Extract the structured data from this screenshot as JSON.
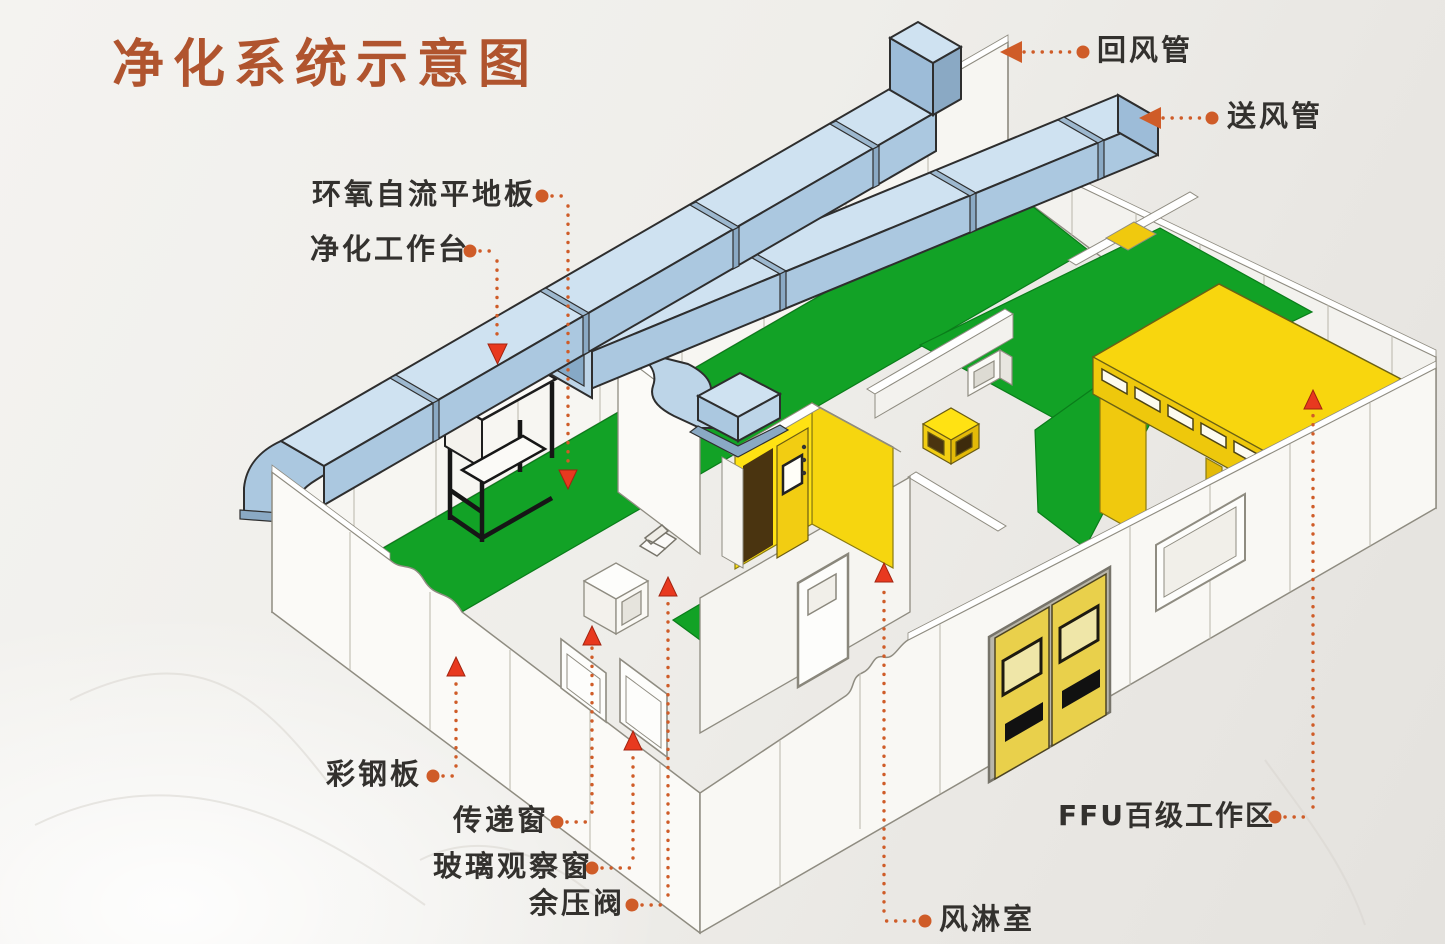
{
  "title": "净化系统示意图",
  "labels": {
    "return_duct": "回风管",
    "supply_duct": "送风管",
    "epoxy_floor": "环氧自流平地板",
    "workbench": "净化工作台",
    "steel_panel": "彩钢板",
    "transfer_window": "传递窗",
    "glass_window": "玻璃观察窗",
    "pressure_valve": "余压阀",
    "air_shower": "风淋室",
    "ffu_area": "FFU百级工作区"
  },
  "colors": {
    "title_orange": "#b0542e",
    "leader_orange": "#cf5c28",
    "marker_red": "#e8391f",
    "duct_blue": "#aecde5",
    "floor_green": "#12a226",
    "panel_yellow": "#f6d411",
    "label_text": "#33312e"
  }
}
